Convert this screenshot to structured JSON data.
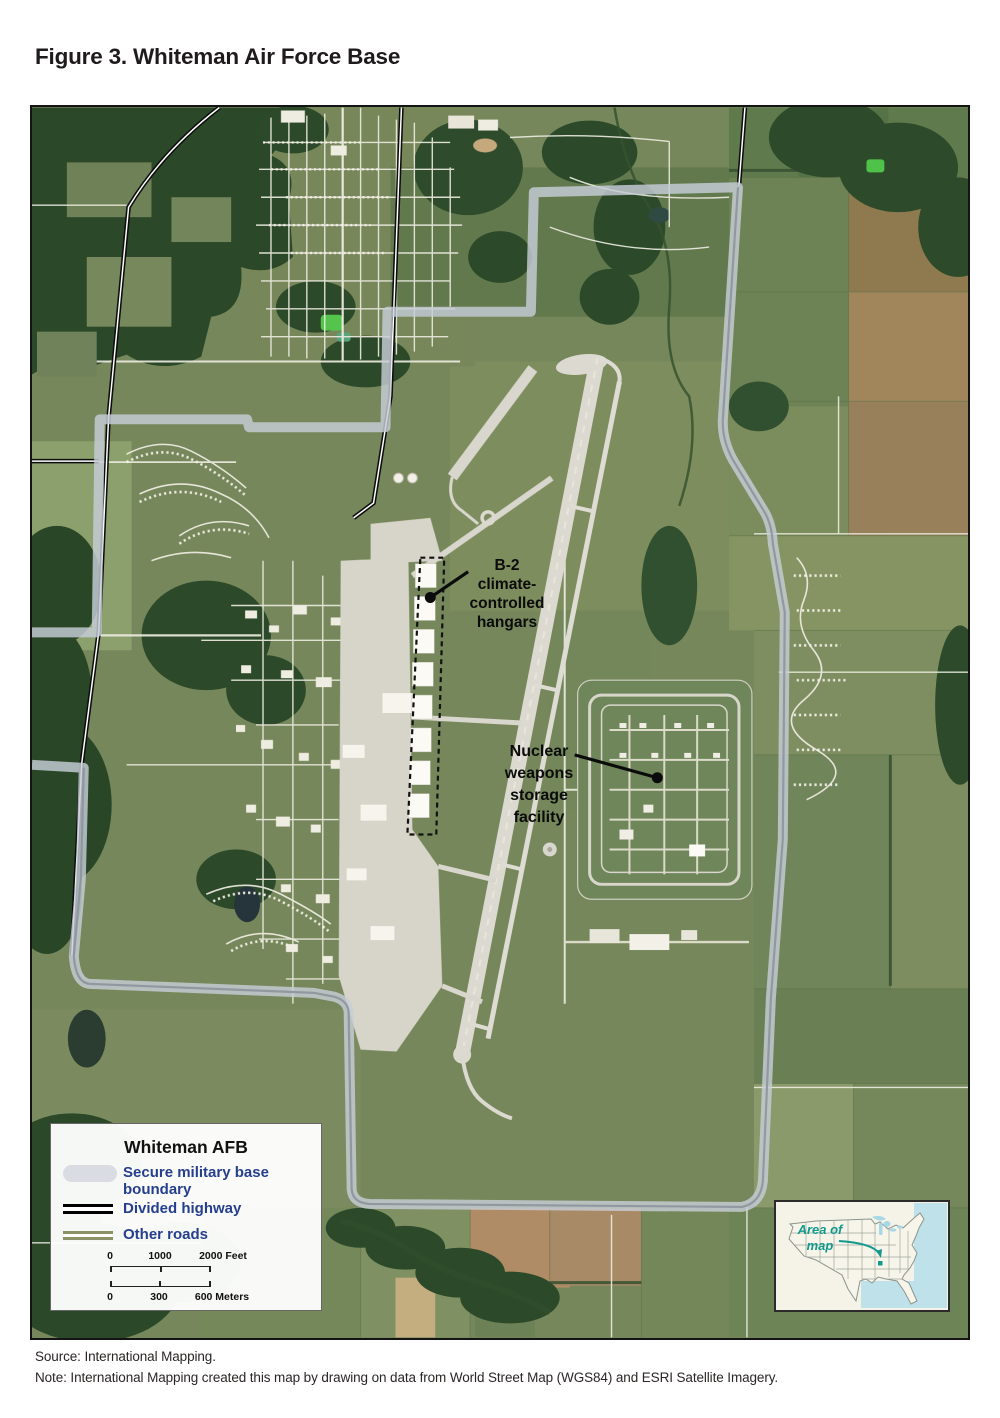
{
  "figure": {
    "title": "Figure 3. Whiteman Air Force Base"
  },
  "map": {
    "annotations": {
      "hangars": {
        "label": "B-2\nclimate-\ncontrolled\nhangars"
      },
      "nuclear": {
        "label": "Nuclear\nweapons\nstorage\nfacility"
      }
    },
    "legend": {
      "title": "Whiteman AFB",
      "items": [
        {
          "name": "secure-boundary",
          "label": "Secure military base boundary",
          "color": "#d9dce2"
        },
        {
          "name": "divided-highway",
          "label": "Divided highway",
          "color": "#000000"
        },
        {
          "name": "other-roads",
          "label": "Other roads",
          "color": "#8a9164"
        }
      ],
      "scale": {
        "feet": {
          "ticks": [
            "0",
            "1000",
            "2000 Feet"
          ]
        },
        "meters": {
          "ticks": [
            "0",
            "300",
            "600 Meters"
          ]
        }
      }
    },
    "inset": {
      "label": "Area of\nmap"
    }
  },
  "footer": {
    "source": "Source: International Mapping.",
    "note": "Note: International Mapping created this map by drawing on data from World Street Map (WGS84) and ESRI Satellite Imagery."
  },
  "colors": {
    "legend_text_blue": "#253f8e",
    "inset_teal": "#12998c",
    "boundary_gray": "#c7cdd7",
    "forest_green": "#2c4a2a",
    "field_olive": "#76875b"
  }
}
